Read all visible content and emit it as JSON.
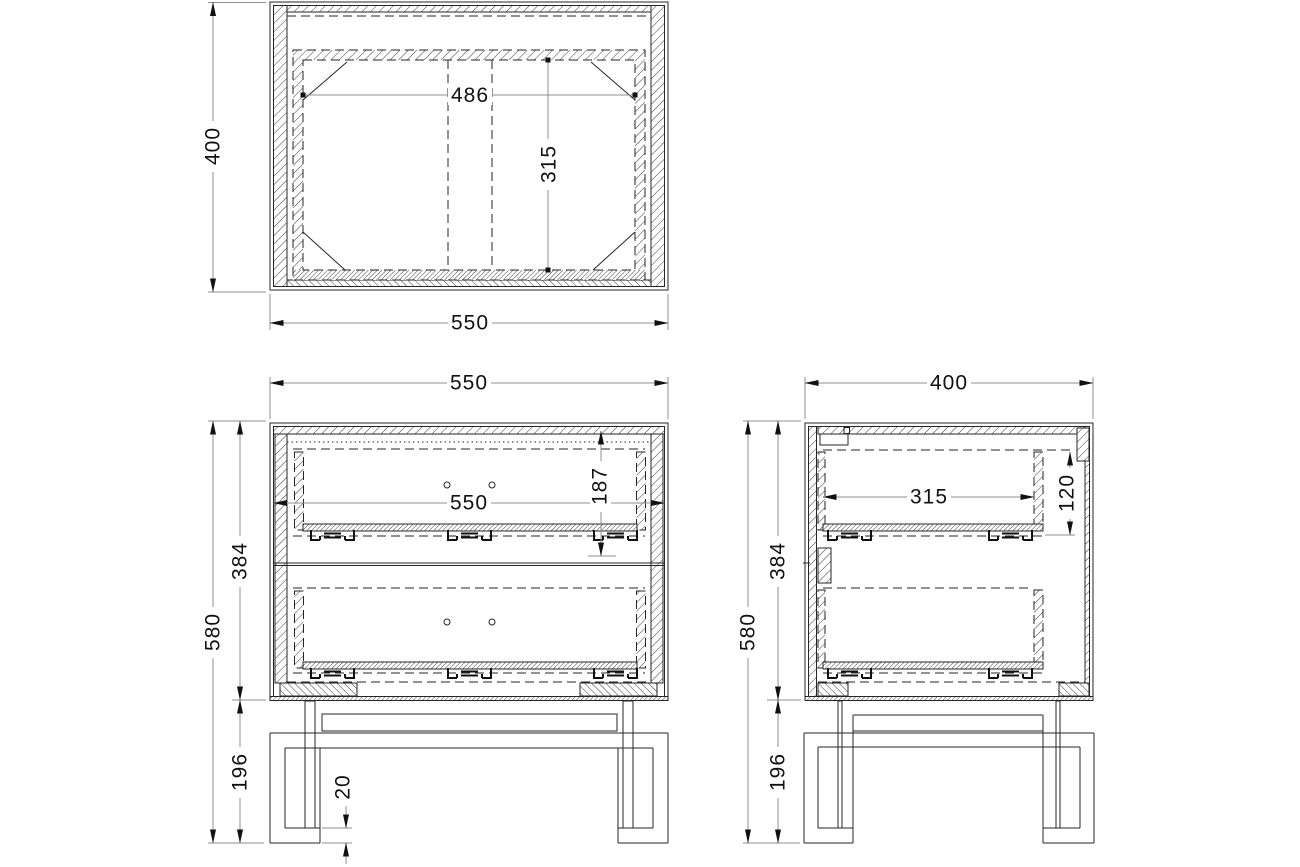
{
  "drawing": {
    "views": {
      "top": {
        "width": "550",
        "depth": "400",
        "inner_width": "486",
        "inner_depth": "315"
      },
      "front": {
        "width": "550",
        "inner_width": "550",
        "drawer_opening_height": "187",
        "carcass_height": "384",
        "total_height": "580",
        "base_height": "196",
        "foot_thickness": "20"
      },
      "side": {
        "depth": "400",
        "drawer_depth": "315",
        "drawer_side_height": "120",
        "carcass_height": "384",
        "total_height": "580",
        "base_height": "196"
      }
    }
  },
  "colors": {
    "background": "#ffffff",
    "object_line": "#262626",
    "dimension_line": "#8f8f8f",
    "text": "#111111"
  }
}
